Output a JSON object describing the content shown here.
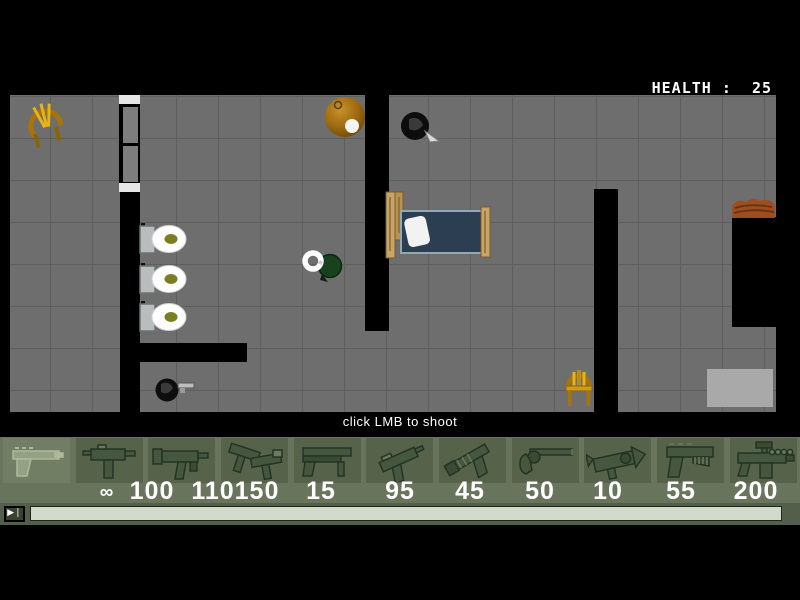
{
  "hud": {
    "health_label": "HEALTH :",
    "health_value": "25",
    "hint": "click LMB to shoot"
  },
  "weapon_bar": {
    "slots": [
      {
        "weapon": "desert-eagle",
        "ammo": "∞",
        "selected": true
      },
      {
        "weapon": "mac10",
        "ammo": "100",
        "selected": false
      },
      {
        "weapon": "mp5",
        "ammo": "110",
        "selected": false
      },
      {
        "weapon": "dual-uzi",
        "ammo": "150",
        "selected": false
      },
      {
        "weapon": "shotgun",
        "ammo": "15",
        "selected": false
      },
      {
        "weapon": "tmp",
        "ammo": "95",
        "selected": false
      },
      {
        "weapon": "silenced-pistol",
        "ammo": "45",
        "selected": false
      },
      {
        "weapon": "revolver",
        "ammo": "50",
        "selected": false
      },
      {
        "weapon": "rocket-launcher",
        "ammo": "10",
        "selected": false
      },
      {
        "weapon": "machine-pistol",
        "ammo": "55",
        "selected": false
      },
      {
        "weapon": "scoped-rifle",
        "ammo": "200",
        "selected": false
      }
    ]
  },
  "playback": {
    "play_button": "▶❘"
  },
  "colors": {
    "floor": "#6e6e6e",
    "wall": "#000000",
    "bar_bg": "#68745b",
    "tile": "#57624a",
    "tile_selected": "#727e64",
    "ammo_text": "#ffffff",
    "track": "#d4dac9",
    "health_text": "#ffffff"
  }
}
